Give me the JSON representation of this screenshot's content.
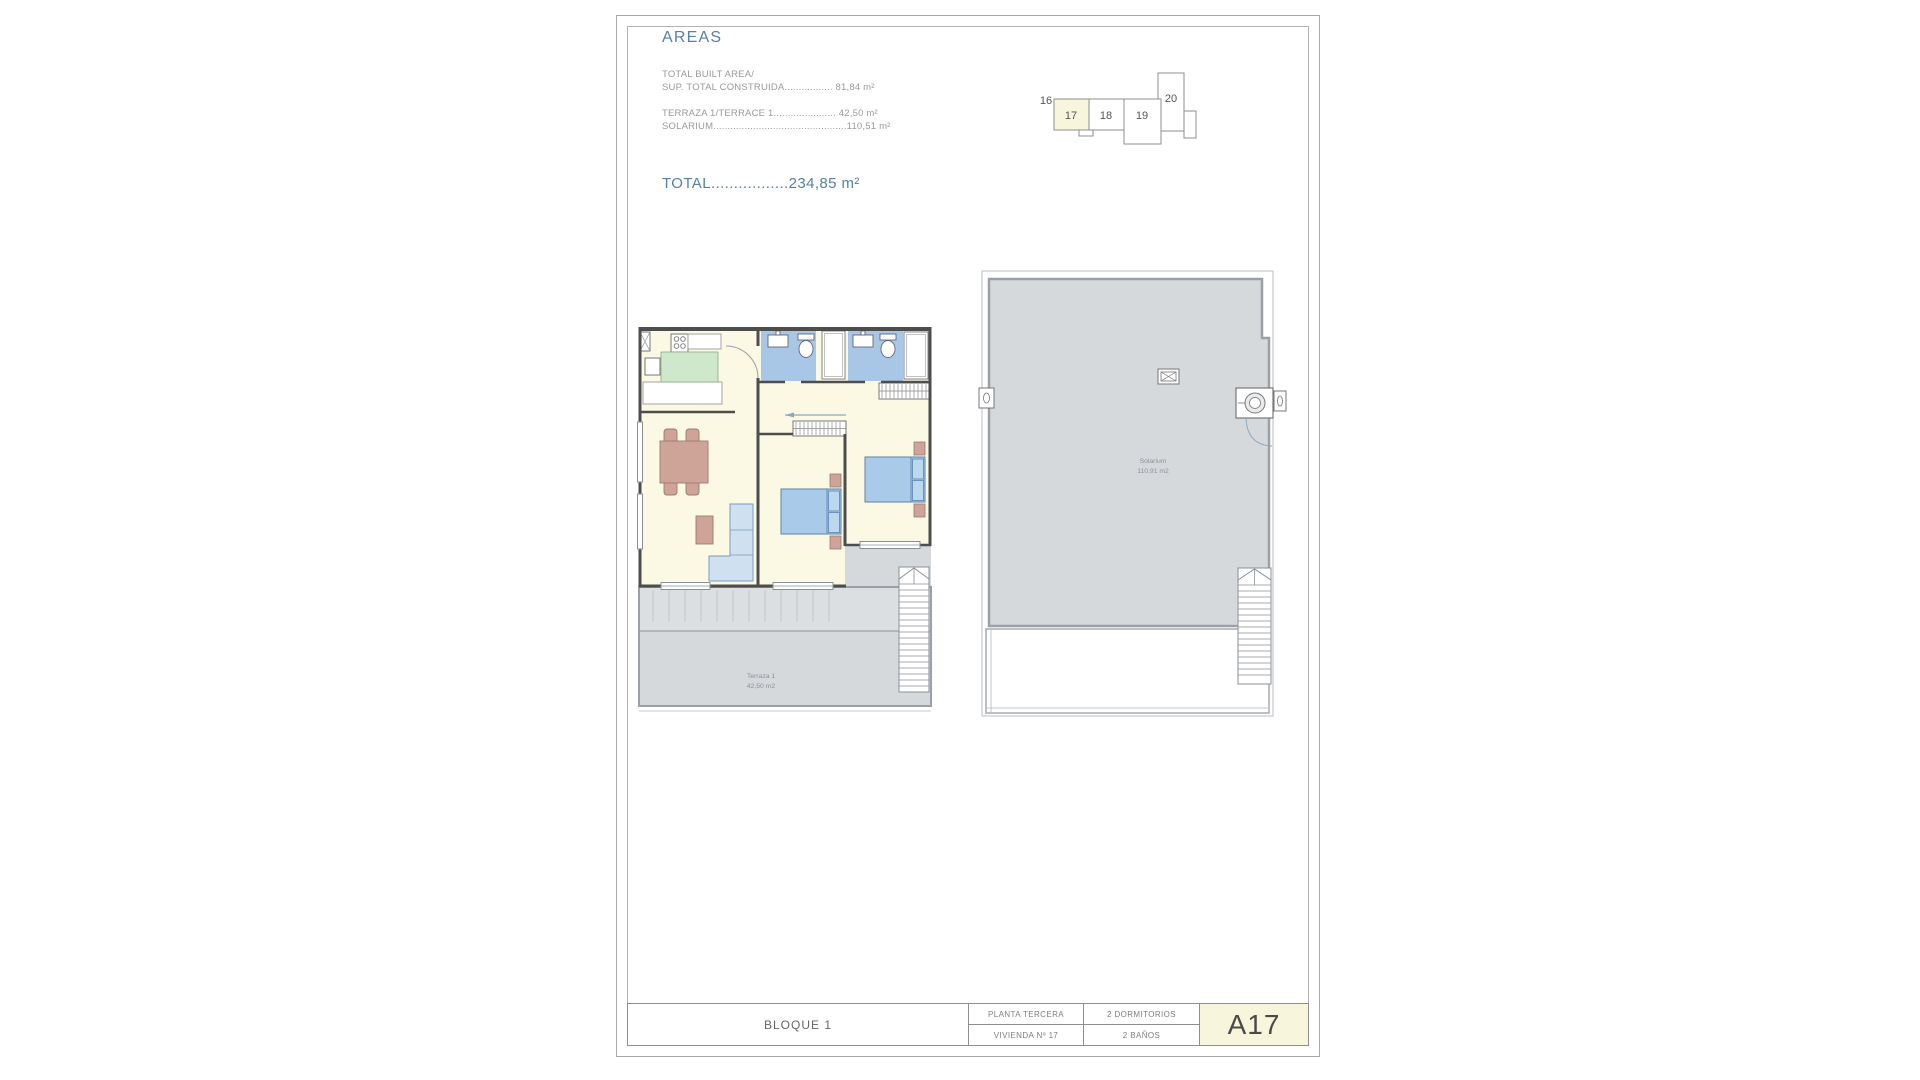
{
  "colors": {
    "accent_blue": "#5580a8",
    "highlight_cream": "#f8f5dd",
    "floor_cream": "#fbf9e3",
    "bath_blue": "#a8c6e6",
    "bed_blue": "#a9cbe9",
    "sofa_blue": "#cfe0f1",
    "furniture_tan": "#cfa498",
    "kitchen_green": "#cfe7cb",
    "terrace_gray": "#d6d9dc",
    "wall_dark": "#4d4d4d"
  },
  "areas_panel": {
    "heading": "AREAS",
    "built_label": "TOTAL BUILT AREA/",
    "built_line": "SUP. TOTAL CONSTRUIDA................. 81,84 m²",
    "terrace_line": "TERRAZA 1/TERRACE 1...................... 42,50 m²",
    "solarium_line": "SOLARIUM...............................................110,51 m²",
    "total_line": "TOTAL.................234,85 m²"
  },
  "key_plan": {
    "highlighted_unit": "17",
    "units": [
      {
        "label": "16"
      },
      {
        "label": "17"
      },
      {
        "label": "18"
      },
      {
        "label": "19"
      },
      {
        "label": "20"
      }
    ]
  },
  "floor_plan": {
    "terrace_label": "Terraza 1",
    "terrace_area": "42,50 m2"
  },
  "solarium_plan": {
    "label": "Solarium",
    "area": "110,91 m2"
  },
  "title_block": {
    "block": "BLOQUE 1",
    "floor": "PLANTA TERCERA",
    "bedrooms": "2 DORMITORIOS",
    "dwelling": "VIVIENDA Nº 17",
    "bathrooms": "2 BAÑOS",
    "code": "A17"
  }
}
